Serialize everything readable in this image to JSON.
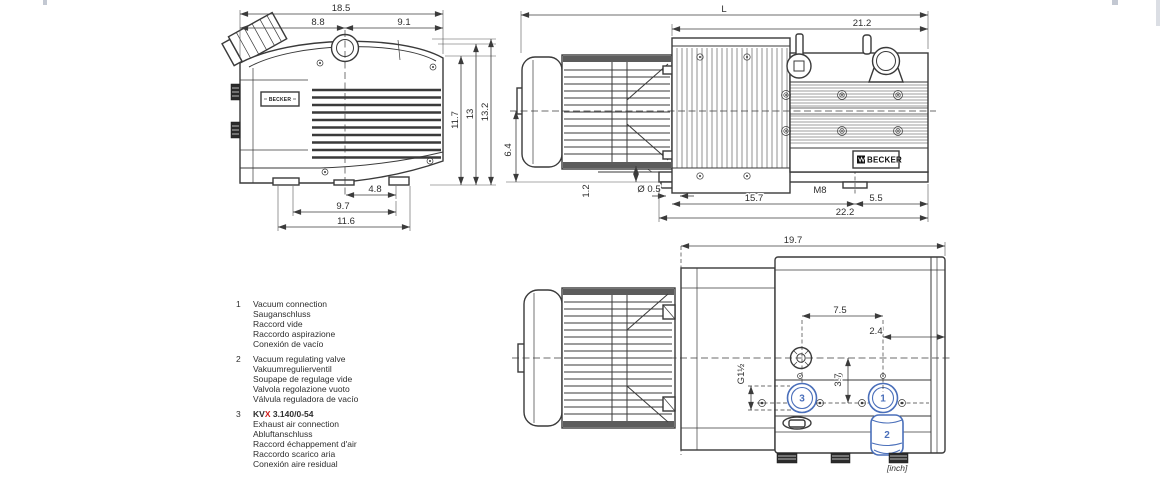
{
  "colors": {
    "line": "#3a3a3a",
    "accent_blue": "#4a6fba",
    "accent_red": "#d02020",
    "background": "#ffffff"
  },
  "brand": "BECKER",
  "views": {
    "side": {
      "dim_total_width": "18.5",
      "dim_left": "8.8",
      "dim_right": "9.1",
      "dim_h1": "11.7",
      "dim_h2": "13",
      "dim_h3": "13.2",
      "dim_feet1": "4.8",
      "dim_feet2": "9.7",
      "dim_feet3": "11.6"
    },
    "front": {
      "dim_L": "L",
      "dim_pump": "21.2",
      "dim_axis": "6.4",
      "dim_step": "1.2",
      "dim_hole": "Ø 0.5",
      "dim_span": "15.7",
      "thread": "M8",
      "dim_end": "5.5",
      "dim_base": "22.2"
    },
    "top": {
      "dim_len": "19.7",
      "dim_ports": "7.5",
      "dim_end": "2.4",
      "dim_offset": "3.7",
      "thread": "G1½",
      "callout1": "1",
      "callout2": "2",
      "callout3": "3",
      "unit_note": "[inch]"
    }
  },
  "legend": {
    "items": [
      {
        "num": "1",
        "lines": [
          "Vacuum connection",
          "Sauganschluss",
          "Raccord vide",
          "Raccordo aspirazione",
          "Conexión de vacío"
        ]
      },
      {
        "num": "2",
        "lines": [
          "Vacuum regulating valve",
          "Vakuumregulierventil",
          "Soupape de regulage vide",
          "Valvola regolazione vuoto",
          "Válvula reguladora de vacío"
        ]
      },
      {
        "num": "3",
        "model": {
          "prefix": "KV",
          "x": "X",
          "suffix": " 3.140/0-54"
        },
        "lines": [
          "Exhaust air connection",
          "Abluftanschluss",
          "Raccord échappement d'air",
          "Raccordo scarico aria",
          "Conexión aire residual"
        ]
      }
    ]
  }
}
